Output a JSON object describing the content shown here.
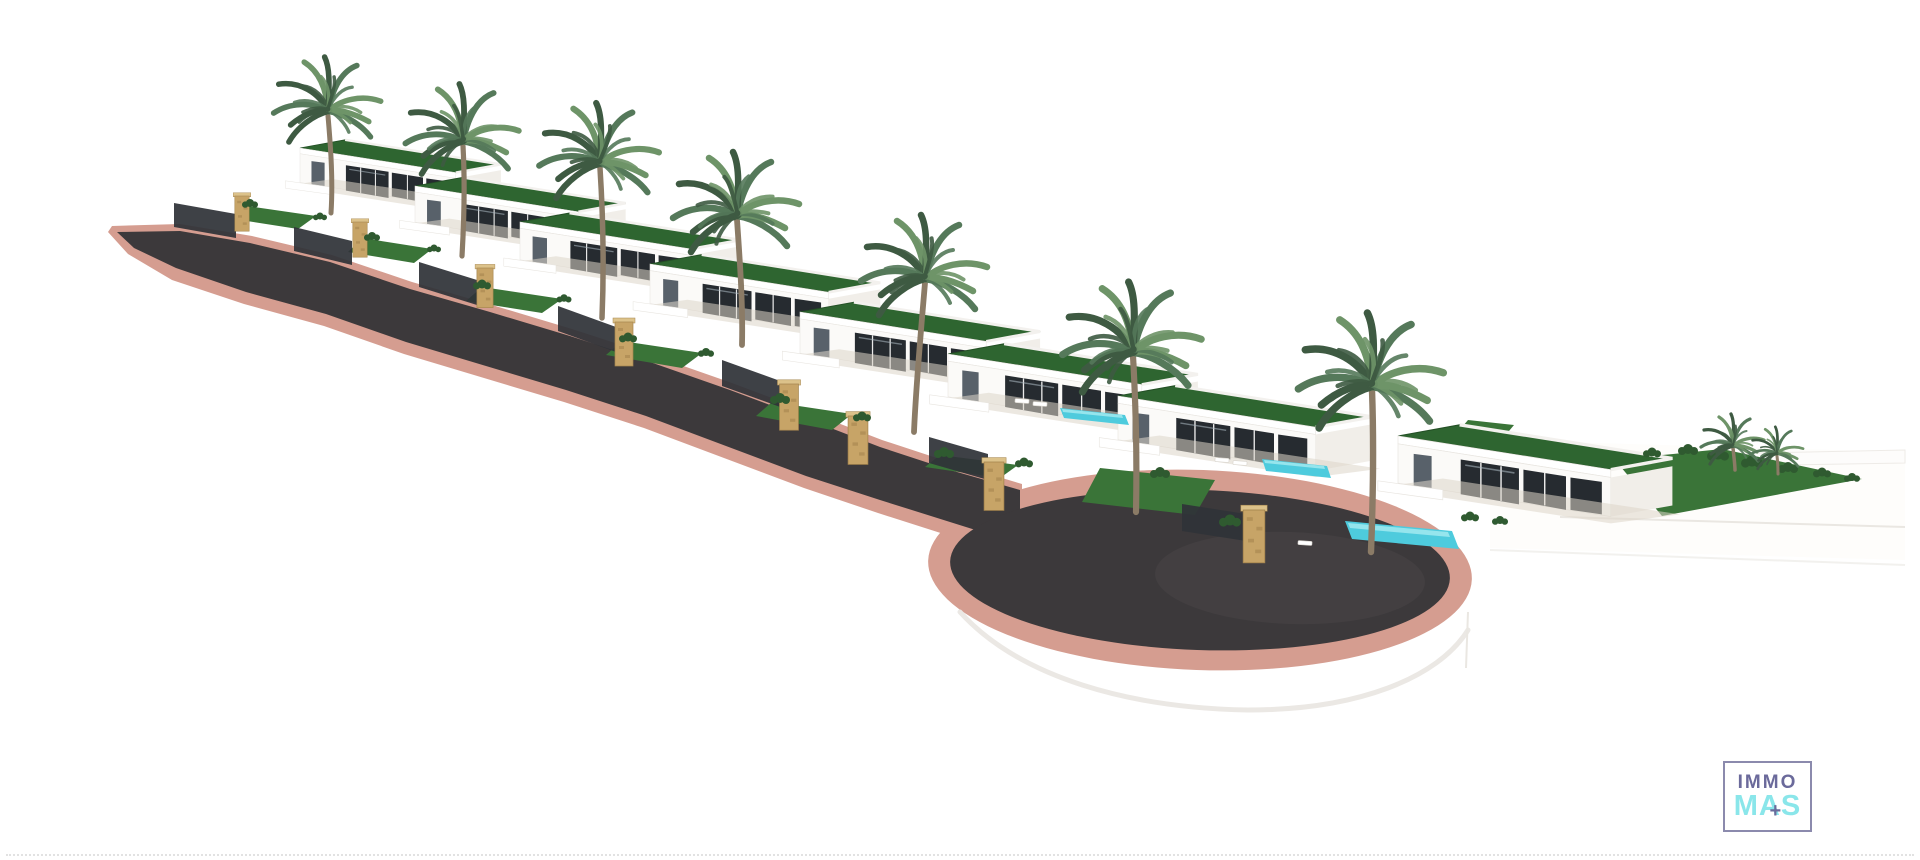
{
  "title": "3D aerial rendering of a hillside villa development",
  "scene": {
    "description": "Row of white modern villas with green rooftop gardens and tall palm trees staggered down a slope; a dark asphalt road with pink curbs descends from upper left and ends in a rounded cul-de-sac; turquoise swimming pools on the terraces; a green lawn with shrubs and small palms on the right plateau; white ground everywhere else.",
    "villa_count": 8,
    "palm_count": 9,
    "pool_count": 3,
    "pillar_count": 8
  },
  "logo": {
    "top": "IMMO",
    "bottom": "MAS",
    "plus": "+"
  },
  "colors": {
    "background": "#ffffff",
    "asphalt": "#3c393b",
    "asphalt_light": "#4b4849",
    "curb_pink": "#d59d90",
    "curb_pink_light": "#e4b6aa",
    "roof_grass": "#2e6530",
    "roof_grass_dark": "#234f25",
    "lawn": "#3a7438",
    "shrub_green": "#2f5a30",
    "palm_dark": "#3e5a42",
    "palm_mid": "#55795a",
    "palm_light": "#6e9468",
    "trunk": "#8b7b66",
    "stone": "#c7a467",
    "stone_dark": "#a5854e",
    "fence": "#2f3338",
    "pool": "#4ecbdd",
    "pool_light": "#a7ebf1",
    "terrace": "#ddd6c9",
    "villa_side": "#f1eee9",
    "window_dark": "#262b30",
    "window_glass": "#46505a",
    "edge_gray": "#e8e5e0",
    "logo_purple": "#6b6a9b",
    "logo_cyan": "#8ae6ea",
    "logo_border": "#8b8aad",
    "dotted_line": "#d6d6d6"
  }
}
